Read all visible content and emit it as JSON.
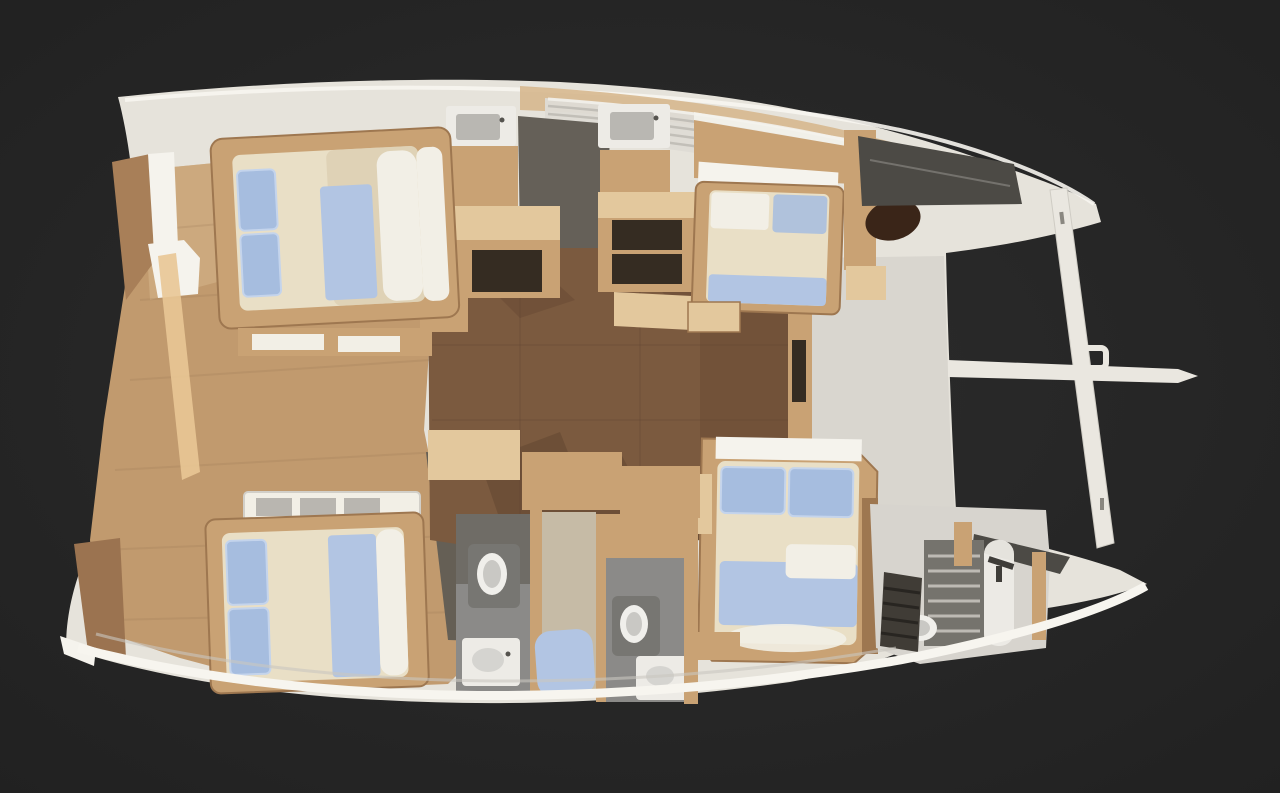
{
  "scene": {
    "subject": "catamaran-yacht-interior-floorplan-3d-render",
    "view": "top-down",
    "bow_direction": "right",
    "hulls": 2,
    "double_beds": 4,
    "toilets": 3,
    "sinks": 4,
    "showers": 1,
    "stairways": 2
  },
  "colors": {
    "background": "#272727",
    "background_center": "#2e2e2e",
    "background_edge": "#1f1f1f",
    "hull_white": "#e6e3db",
    "hull_bright": "#f5f3ed",
    "hull_shade": "#d2cfc8",
    "foredeck_gray": "#d0cdc7",
    "rim_highlight": "#f7f5ef",
    "deck_wood": "#c19a6e",
    "deck_wood_light": "#d6b68c",
    "deck_wood_dark": "#a87f58",
    "deck_highlight": "#e9c795",
    "plank_line": "#8a6a4a",
    "salon_floor": "#7b5a3f",
    "salon_floor_dark": "#6d4d36",
    "salon_shadow": "#5e422e",
    "furniture_wood": "#c9a274",
    "furniture_wood_light": "#e3c89d",
    "furniture_wood_dark": "#9e7750",
    "niche_dark": "#352c22",
    "windshield_gray": "#dedbd5",
    "windshield_line": "#b5b2ab",
    "glass_dark": "#4c4a45",
    "galley_floor_gray": "#656058",
    "shadow_gray": "#655f55",
    "bath_floor": "#8b8a88",
    "bath_floor_dark": "#6f6c66",
    "fixture_white": "#edebe6",
    "toilet_rim": "#f0efeb",
    "toilet_bowl": "#c9c8c4",
    "toilet_base": "#777672",
    "bed_cream": "#e9dfc6",
    "bed_cream_shade": "#d9caac",
    "bed_white": "#f2efe6",
    "pillow_blue": "#a6bddf",
    "pillow_blue_light": "#c4d4ec",
    "blanket_blue": "#b2c5e3",
    "shower_beige": "#c6bba6",
    "stair_blue": "#9db2cc",
    "stair_dark": "#2e3340",
    "steps_dark": "#403c36",
    "step_line": "#282521",
    "hatch_brown": "#3a2518",
    "beam_white": "#eae7e0",
    "beam_shade": "#cfccc4"
  }
}
